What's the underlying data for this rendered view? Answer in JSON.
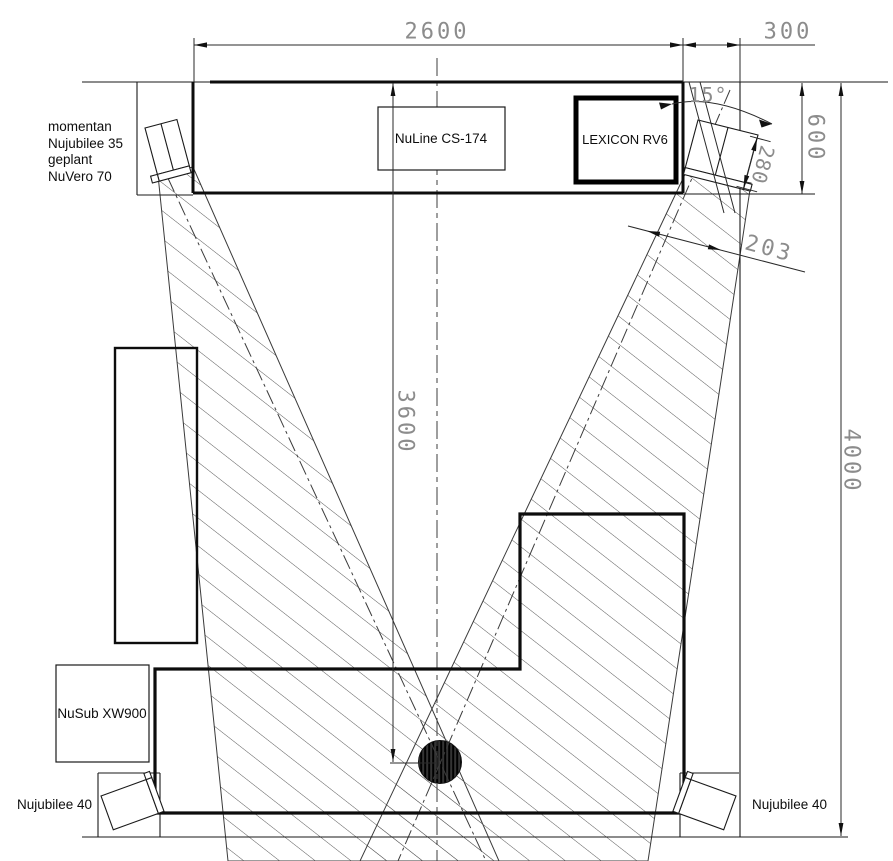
{
  "labels": {
    "front_left_lines": [
      "momentan",
      "Nujubilee 35",
      "geplant",
      "NuVero 70"
    ],
    "center_speaker": "NuLine CS-174",
    "av_receiver": "LEXICON RV6",
    "subwoofer": "NuSub XW900",
    "surround_left": "Nujubilee 40",
    "surround_right": "Nujubilee 40"
  },
  "dimensions": {
    "front_wall_width": "2600",
    "corner_niche_width": "300",
    "front_depth": "600",
    "speaker_offset": "280",
    "speaker_wall_gap": "203",
    "listening_distance": "3600",
    "room_length": "4000",
    "toe_in_angle": "15°"
  },
  "colors": {
    "line": "#1a1a1a",
    "dimension_text": "#8c8c8c",
    "hatch": "#5a5a5a",
    "background": "#ffffff"
  }
}
